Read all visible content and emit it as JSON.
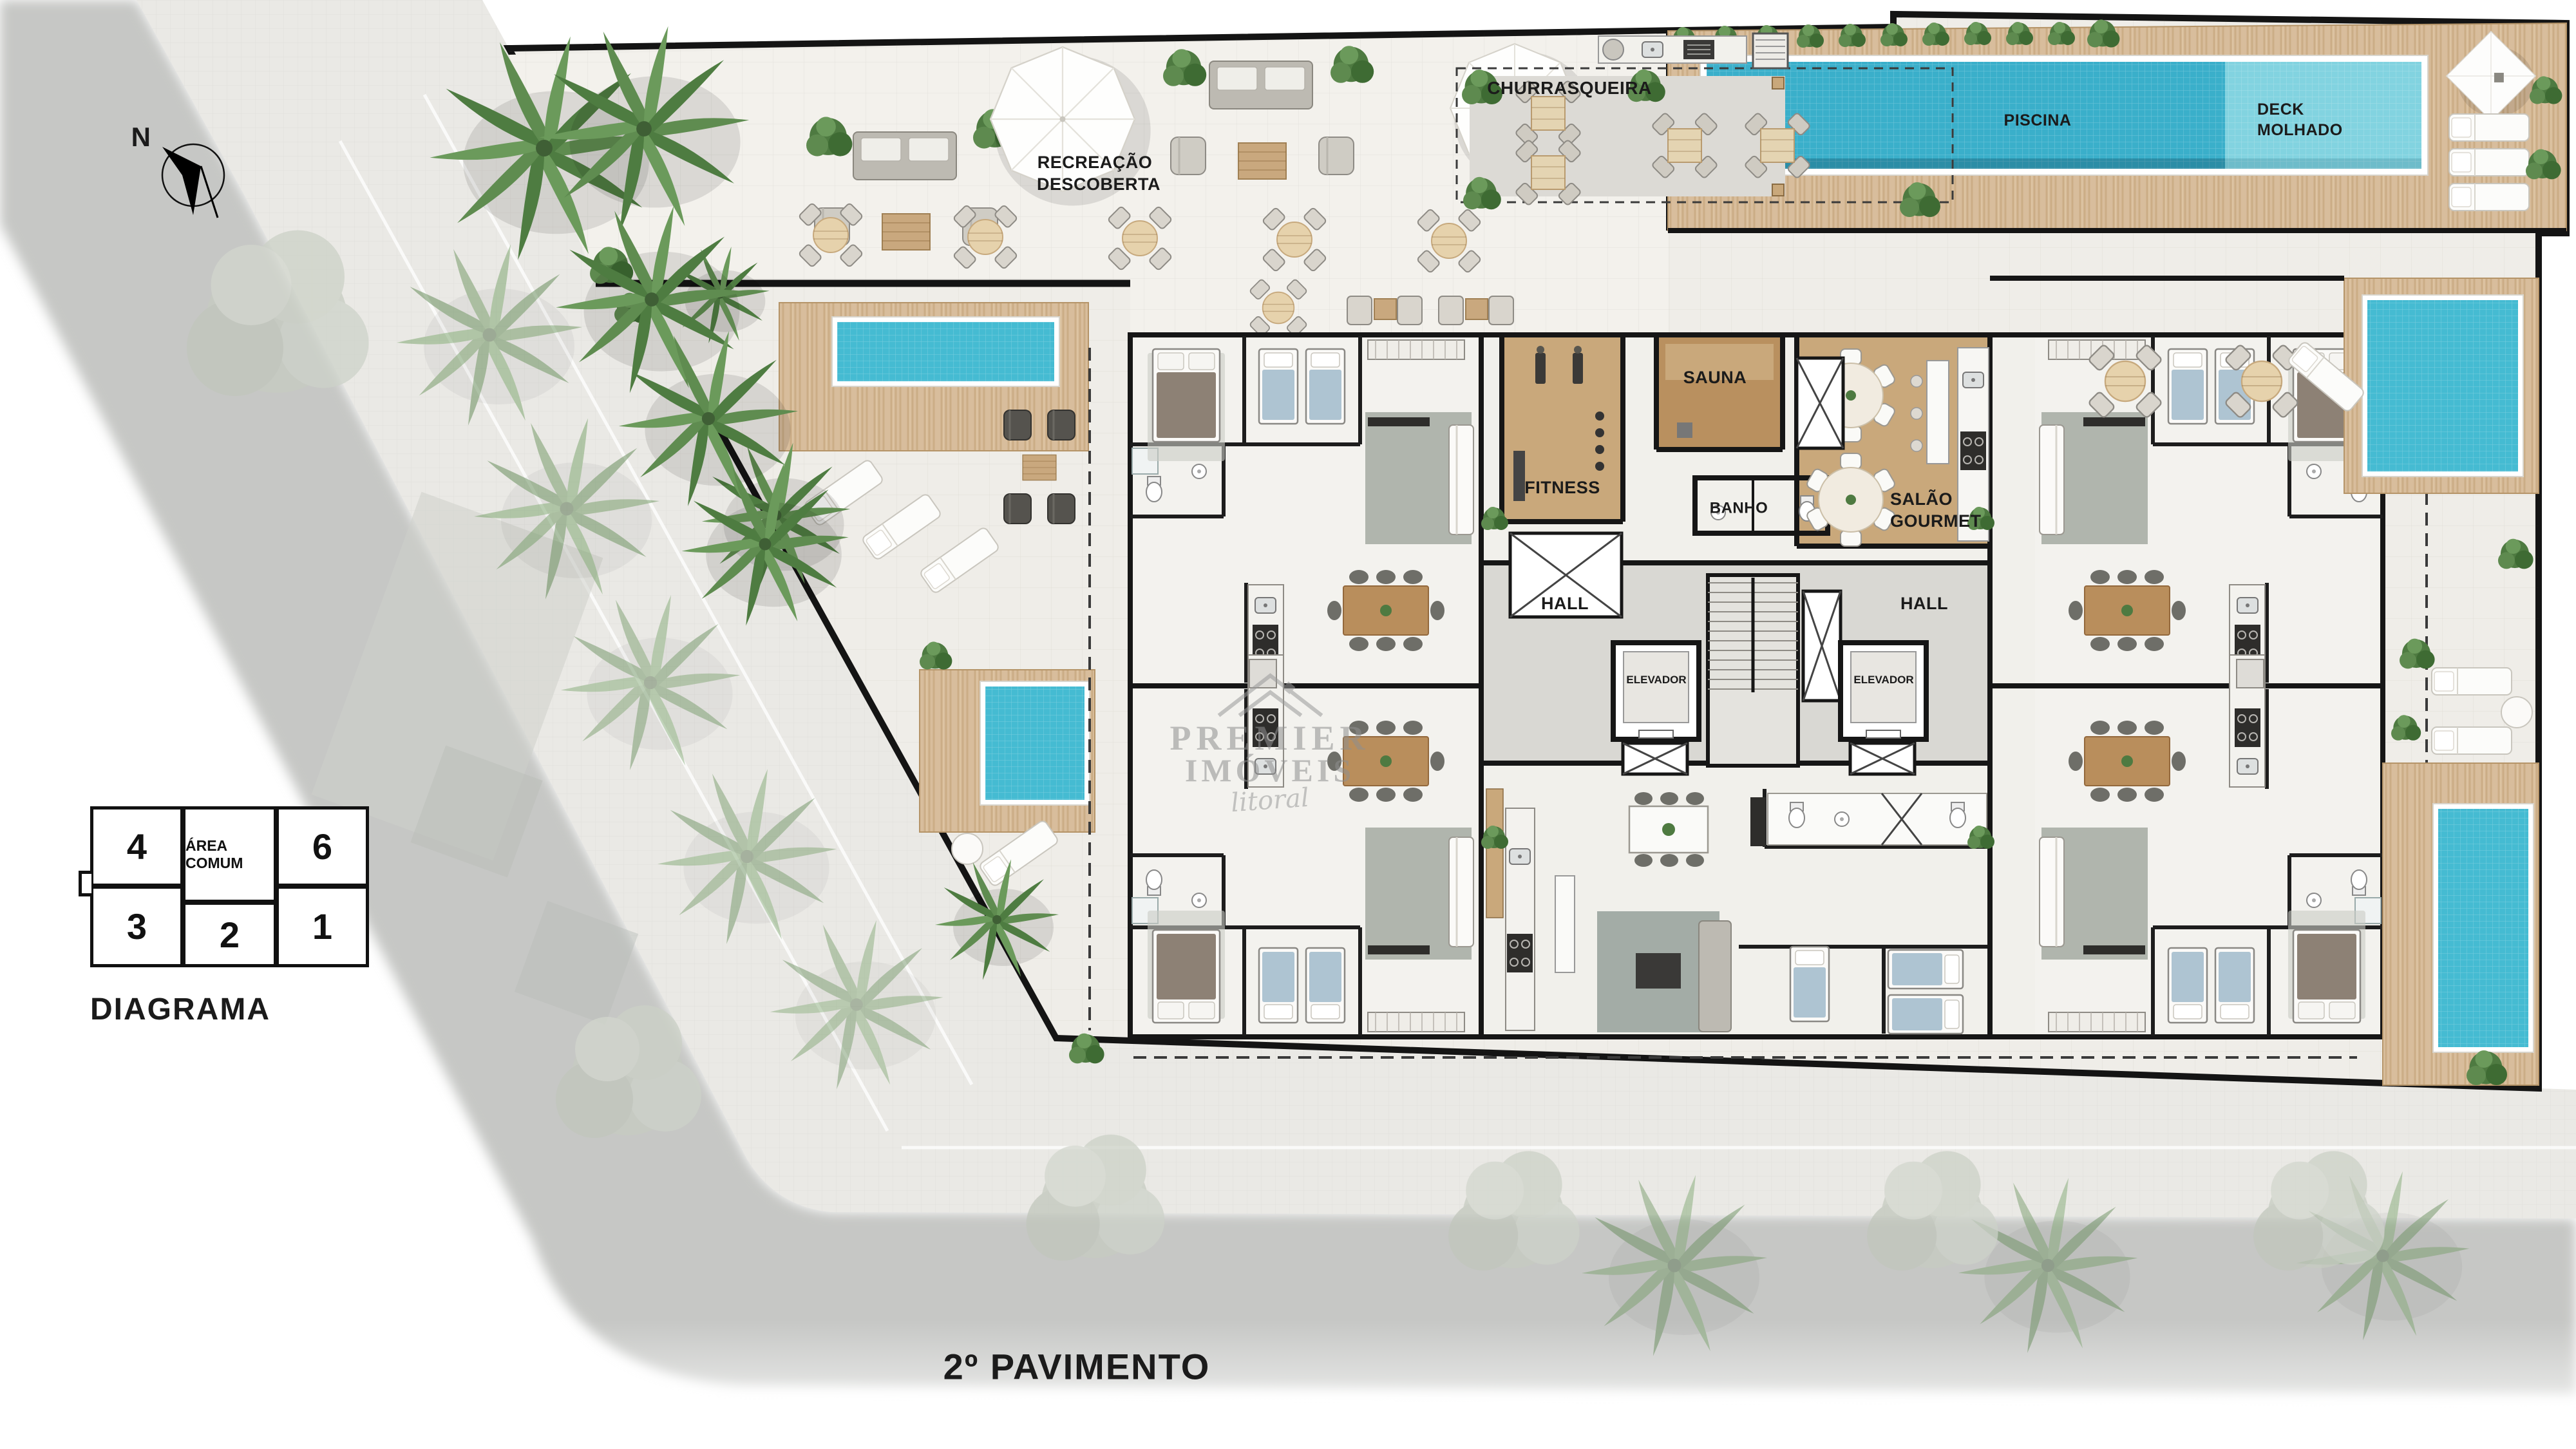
{
  "page_title": "Planta humanizada - 2º Pavimento",
  "compass": {
    "label": "N"
  },
  "labels": {
    "recreacao": {
      "line1": "RECREAÇÃO",
      "line2": "DESCOBERTA"
    },
    "churrasqueira": "CHURRASQUEIRA",
    "piscina": "PISCINA",
    "deck_molhado": {
      "line1": "DECK",
      "line2": "MOLHADO"
    },
    "sauna": "SAUNA",
    "fitness": "FITNESS",
    "banho": "BANHO",
    "salao_gourmet": {
      "line1": "SALÃO",
      "line2": "GOURMET"
    },
    "hall_left": "HALL",
    "hall_right": "HALL",
    "elevador_left": "ELEVADOR",
    "elevador_right": "ELEVADOR"
  },
  "legend": {
    "title": "DIAGRAMA",
    "row1": [
      {
        "label": "4"
      },
      {
        "label": "ÁREA COMUM"
      },
      {
        "label": "6"
      }
    ],
    "row2": [
      {
        "label": "3"
      },
      {
        "label": "2"
      },
      {
        "label": "1"
      }
    ]
  },
  "watermark": {
    "line1": "PREMIER",
    "line2": "IMÓVEIS",
    "line3": "litoral"
  },
  "floor_label": "2º PAVIMENTO",
  "colors": {
    "pool_dark": "#3AAFCA",
    "pool_light": "#82D3E0",
    "pool_small": "#45BBD2",
    "deck_wood": "#D8BD9C",
    "room_wood": "#C9A87B",
    "sauna_wood": "#B9905F",
    "street": "#C6C7C5",
    "sidewalk": "#EAE9E5",
    "plot_floor": "#EFEDE8",
    "hall_floor": "#D9D8D3",
    "wall": "#161616",
    "vegetation": "#4E7A41"
  }
}
